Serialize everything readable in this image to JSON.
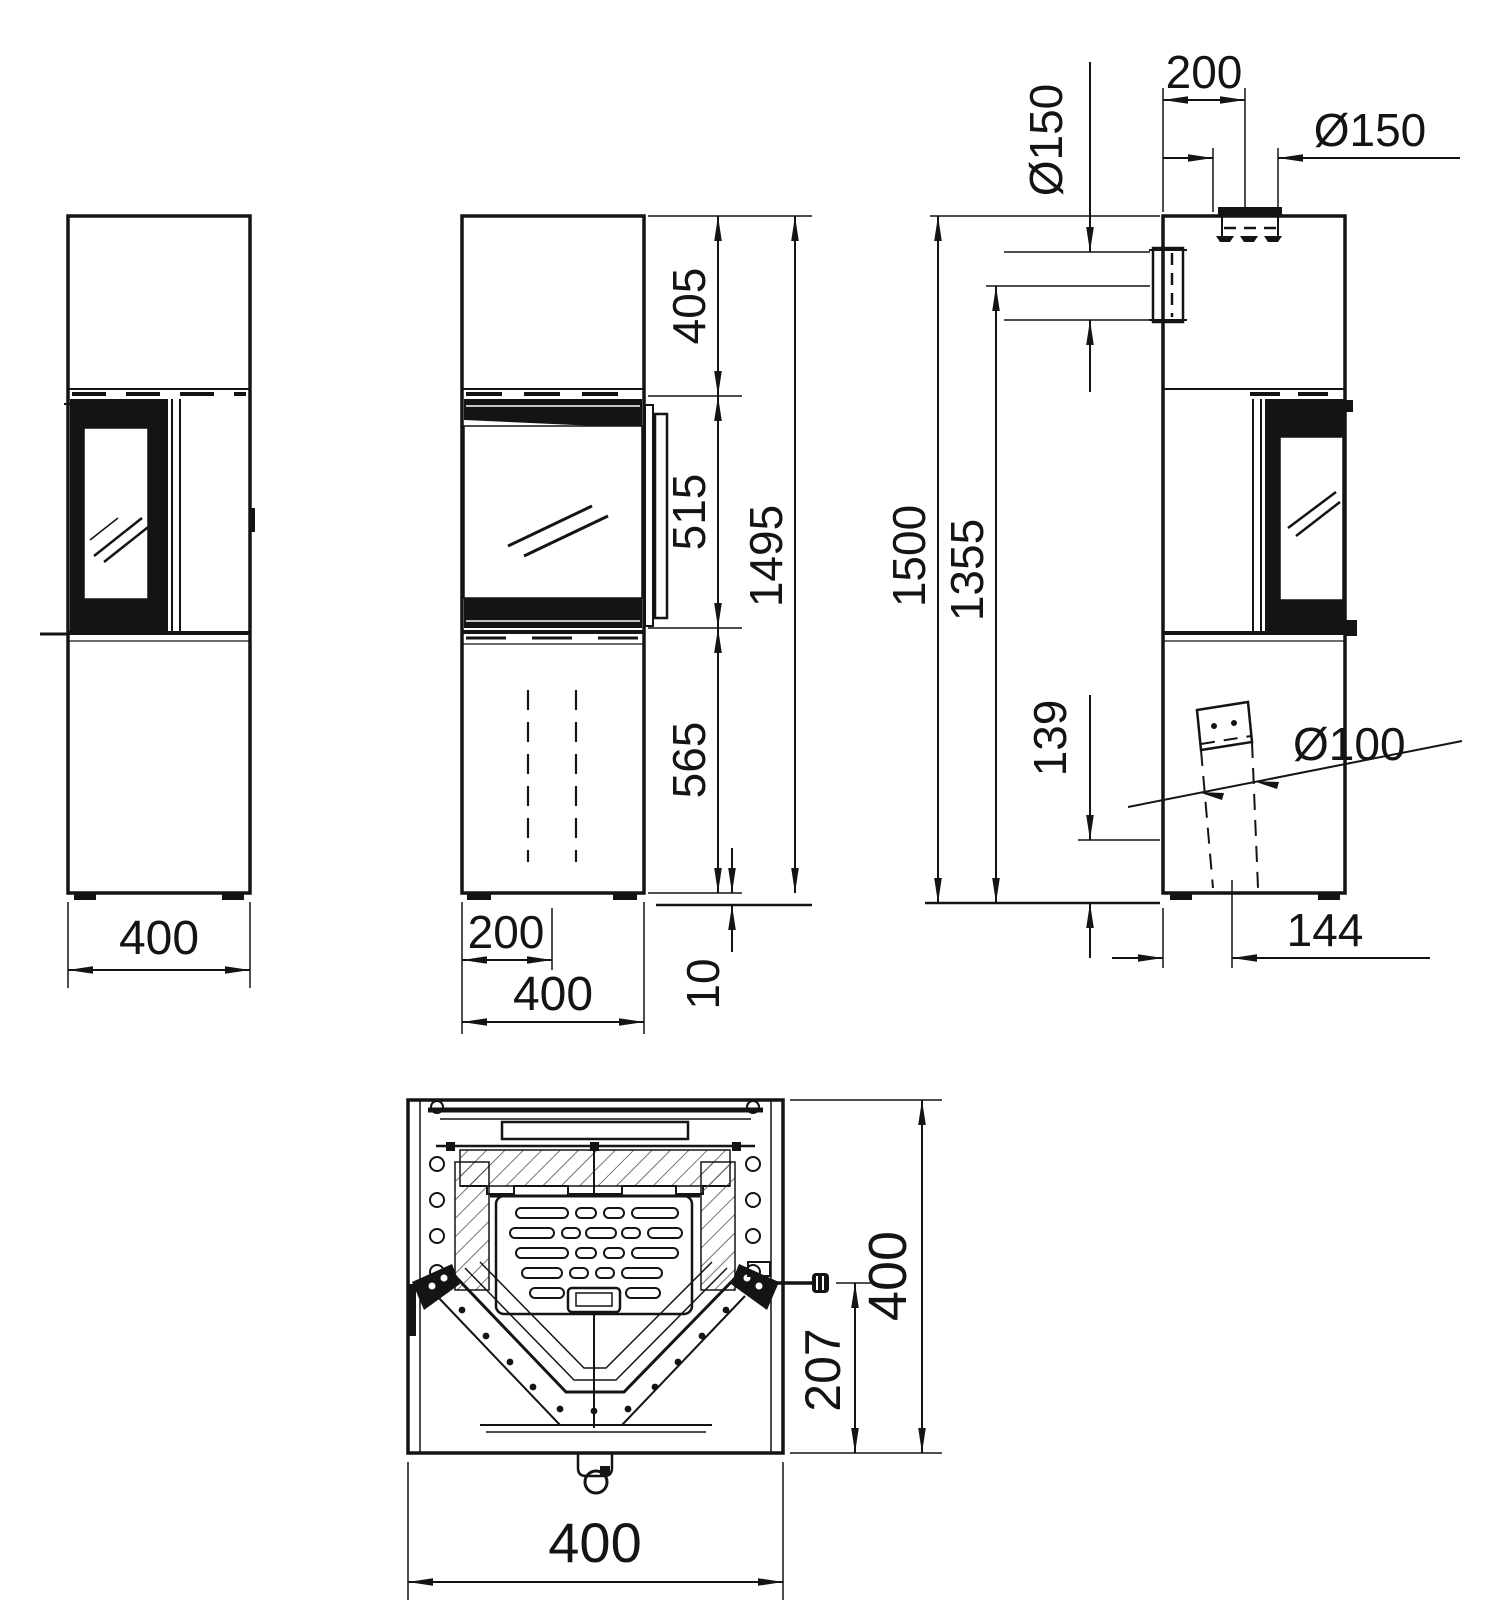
{
  "drawing": {
    "type": "stove-technical-drawing",
    "colors": {
      "ink": "#141414",
      "background": "#ffffff"
    },
    "views": [
      "side-left",
      "front",
      "side-right",
      "plan-section"
    ],
    "dims": {
      "left_width": "400",
      "front_top": "405",
      "front_window": "515",
      "front_total": "1495",
      "front_base": "565",
      "front_feet": "10",
      "front_half_width": "200",
      "front_width": "400",
      "right_rear_flue_dia": "Ø150",
      "right_top_flue_offset": "200",
      "right_top_flue_dia": "Ø150",
      "right_height_total": "1500",
      "right_rear_flue_height": "1355",
      "right_air_intake_height": "139",
      "right_air_intake_dia": "Ø100",
      "right_air_intake_offset": "144",
      "plan_depth": "400",
      "plan_handle_depth": "207",
      "plan_width": "400"
    }
  }
}
